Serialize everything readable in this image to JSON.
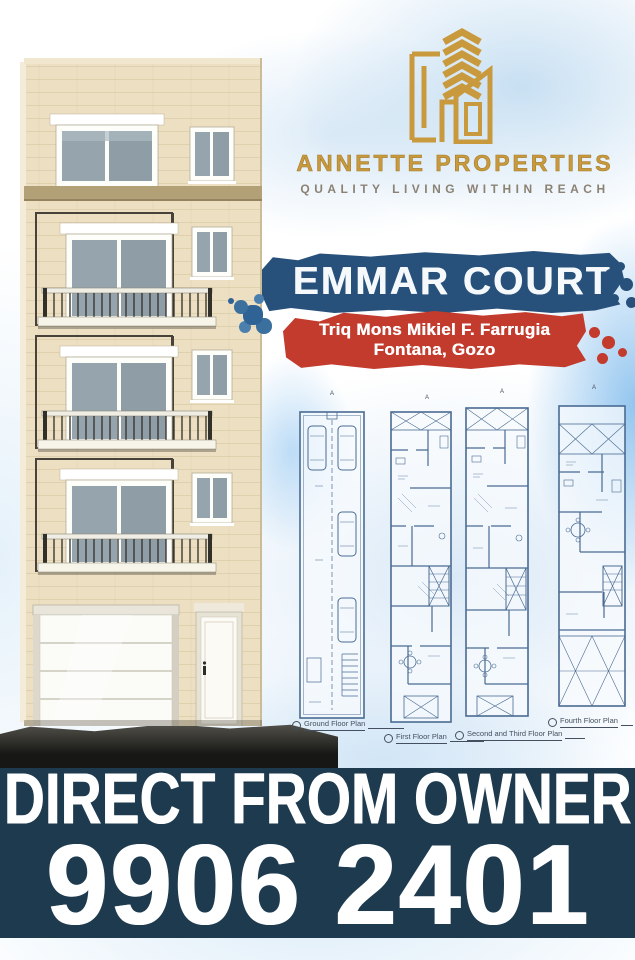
{
  "brand": {
    "name": "ANNETTE PROPERTIES",
    "tagline": "QUALITY LIVING WITHIN REACH",
    "logo_icon": "gold-buildings-with-chevrons",
    "gold_color": "#c9993d",
    "tagline_color": "#8b8274"
  },
  "project": {
    "name": "EMMAR COURT",
    "address_line1": "Triq Mons Mikiel F. Farrugia",
    "address_line2": "Fontana, Gozo",
    "name_banner_color": "#27517b",
    "address_banner_color": "#c23b2d"
  },
  "building_render": {
    "alt": "Front elevation render of a five-storey cream limestone apartment block with balconies, garage door and entrance door"
  },
  "floor_plans": {
    "section_marker": "A",
    "items": [
      {
        "label": "Ground Floor Plan"
      },
      {
        "label": "First Floor Plan"
      },
      {
        "label": "Second and Third Floor Plan"
      },
      {
        "label": "Fourth Floor Plan"
      }
    ]
  },
  "footer": {
    "headline": "DIRECT FROM OWNER",
    "phone": "9906 2401",
    "background_color": "#1d3a4e"
  }
}
